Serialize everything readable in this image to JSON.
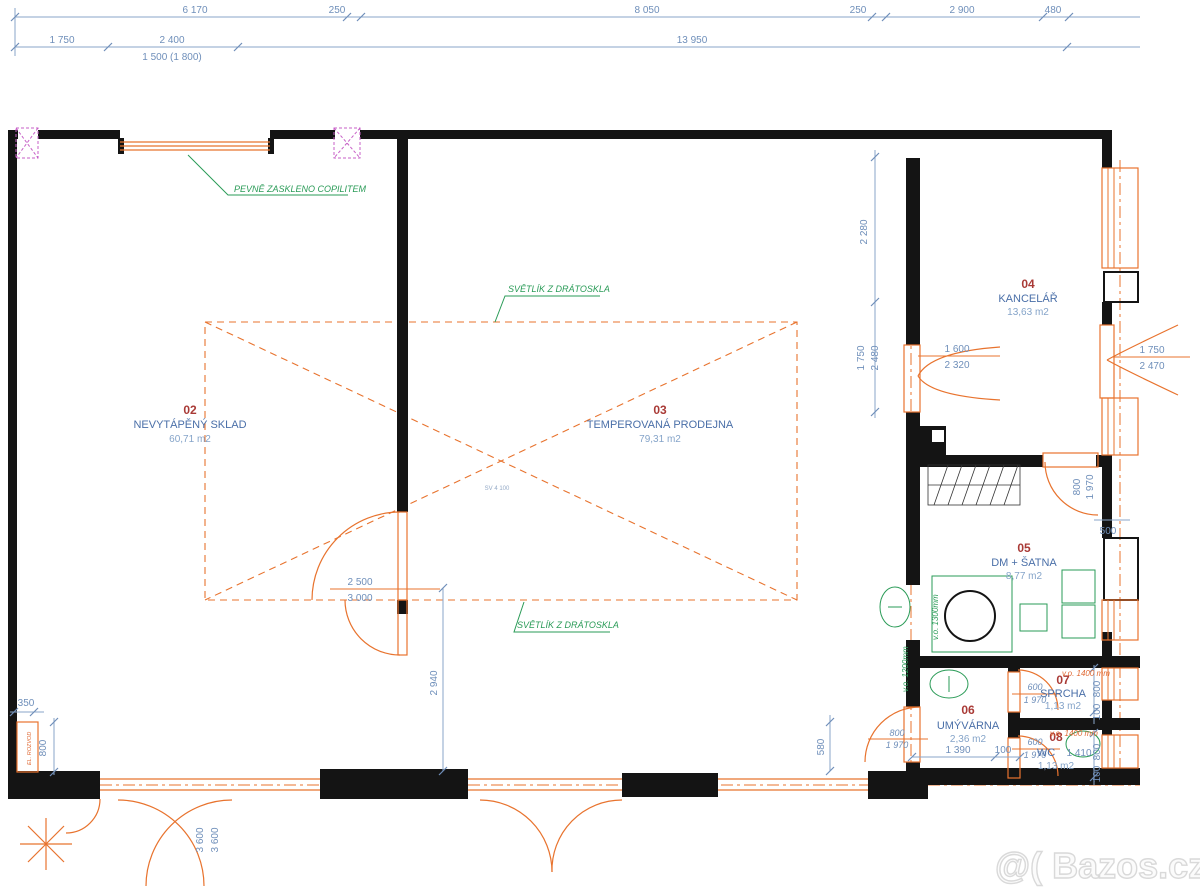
{
  "rooms": [
    {
      "num": "02",
      "name": "NEVYTÁPĚNÝ SKLAD",
      "area": "60,71 m2"
    },
    {
      "num": "03",
      "name": "TEMPEROVANÁ PRODEJNA",
      "area": "79,31 m2"
    },
    {
      "num": "04",
      "name": "KANCELÁŘ",
      "area": "13,63 m2"
    },
    {
      "num": "05",
      "name": "DM + ŠATNA",
      "area": "8,77 m2"
    },
    {
      "num": "06",
      "name": "UMÝVÁRNA",
      "area": "2,36 m2"
    },
    {
      "num": "07",
      "name": "SPRCHA",
      "area": "1,13 m2"
    },
    {
      "num": "08",
      "name": "WC",
      "area": "1,13 m2"
    }
  ],
  "notes": {
    "copilit": "PEVNĚ ZASKLENO COPILITEM",
    "skylight1": "SVĚTLÍK Z DRÁTOSKLA",
    "skylight2": "SVĚTLÍK Z DRÁTOSKLA",
    "sv": "SV 4 100",
    "el": "EL. ROZVOD",
    "vo1300": "v.o. 1300mm",
    "vo1200": "v.o. 1200mm",
    "vo1400a": "v.o. 1400 mm",
    "vo1400b": "v.o. 1400 mm"
  },
  "dims": {
    "t1a": "6 170",
    "t1b": "250",
    "t1c": "8 050",
    "t1d": "250",
    "t1e": "2 900",
    "t1f": "480",
    "t2a": "1 750",
    "t2b": "2 400",
    "t2c": "13 950",
    "t3": "1 500 (1 800)",
    "v2280": "2 280",
    "v1750": "1 750",
    "v2480": "2 480",
    "d1600": "1 600",
    "d2320": "2 320",
    "dr1750": "1 750",
    "dr2470": "2 470",
    "d2500": "2 500",
    "d3000": "3 000",
    "v2940": "2 940",
    "v580": "580",
    "d800a": "800",
    "d1970a": "1 970",
    "d350": "350",
    "v800": "800",
    "r06a": "1 390",
    "r06b": "100",
    "d600a": "600",
    "d1970b": "1 970",
    "r07a": "800",
    "r07b": "100",
    "d600b": "600",
    "d1970c": "1 970",
    "r08a": "800",
    "r08b": "100",
    "wc": "1 410",
    "d500": "500",
    "dd800": "800",
    "dd1970": "1 970",
    "d3600a": "3 600",
    "d3600b": "3 600"
  },
  "watermark": "@( Bazos.cz",
  "colors": {
    "wall": "#141414",
    "dim": "#6f8fba",
    "room_number": "#a93a36",
    "room_name": "#4a6fa8",
    "area": "#85a4c9",
    "green": "#2a9b57",
    "orange": "#e8732e",
    "magenta": "#c75fc7"
  }
}
